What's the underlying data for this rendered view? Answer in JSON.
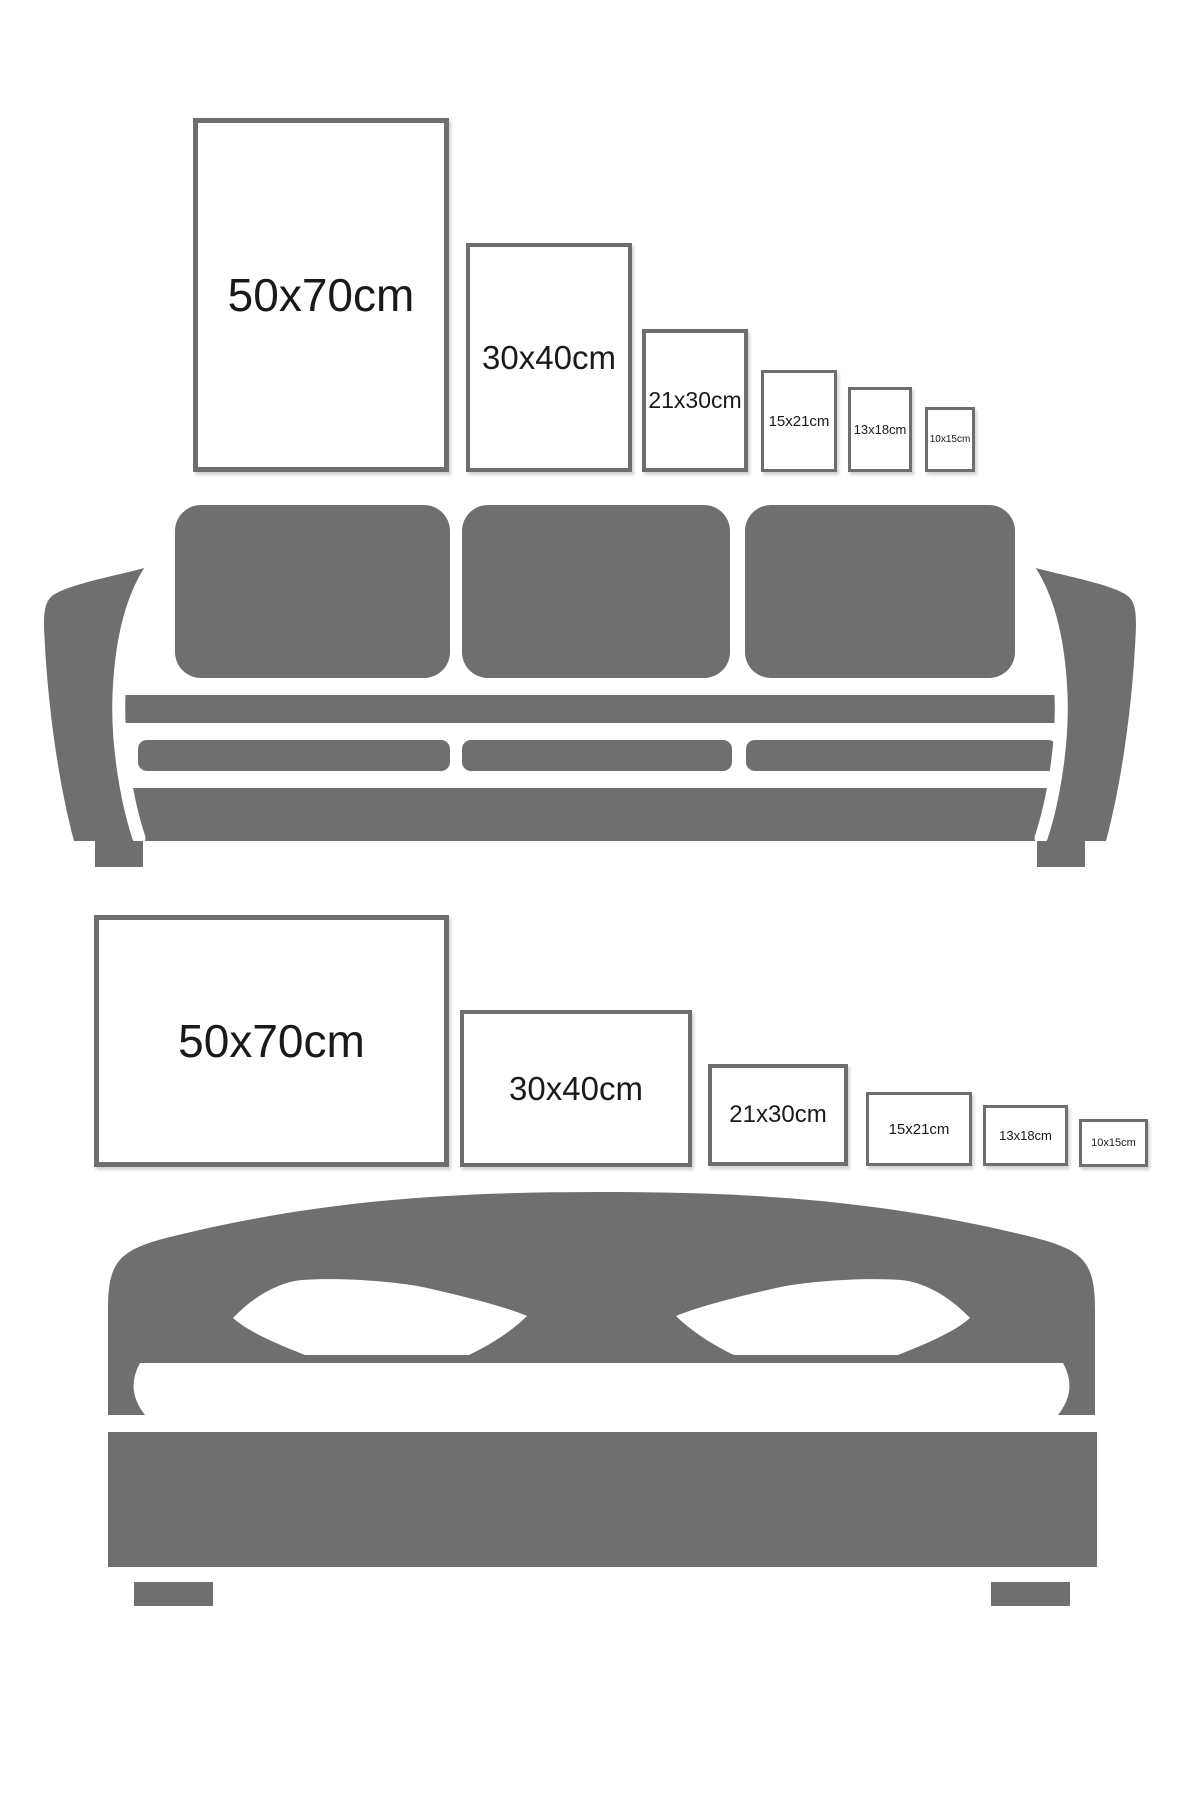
{
  "colors": {
    "background": "#ffffff",
    "furniture": "#6f6f6f",
    "frame_border": "#6e6e6e",
    "frame_fill": "#ffffff",
    "label_text": "#1a1a1a"
  },
  "sections": [
    {
      "id": "sofa-size-guide",
      "illustration": "three-seat-sofa-silhouette",
      "frames": [
        {
          "label": "50x70cm"
        },
        {
          "label": "30x40cm"
        },
        {
          "label": "21x30cm"
        },
        {
          "label": "15x21cm"
        },
        {
          "label": "13x18cm"
        },
        {
          "label": "10x15cm"
        }
      ]
    },
    {
      "id": "bed-size-guide",
      "illustration": "double-bed-silhouette",
      "frames": [
        {
          "label": "50x70cm"
        },
        {
          "label": "30x40cm"
        },
        {
          "label": "21x30cm"
        },
        {
          "label": "15x21cm"
        },
        {
          "label": "13x18cm"
        },
        {
          "label": "10x15cm"
        }
      ]
    }
  ]
}
